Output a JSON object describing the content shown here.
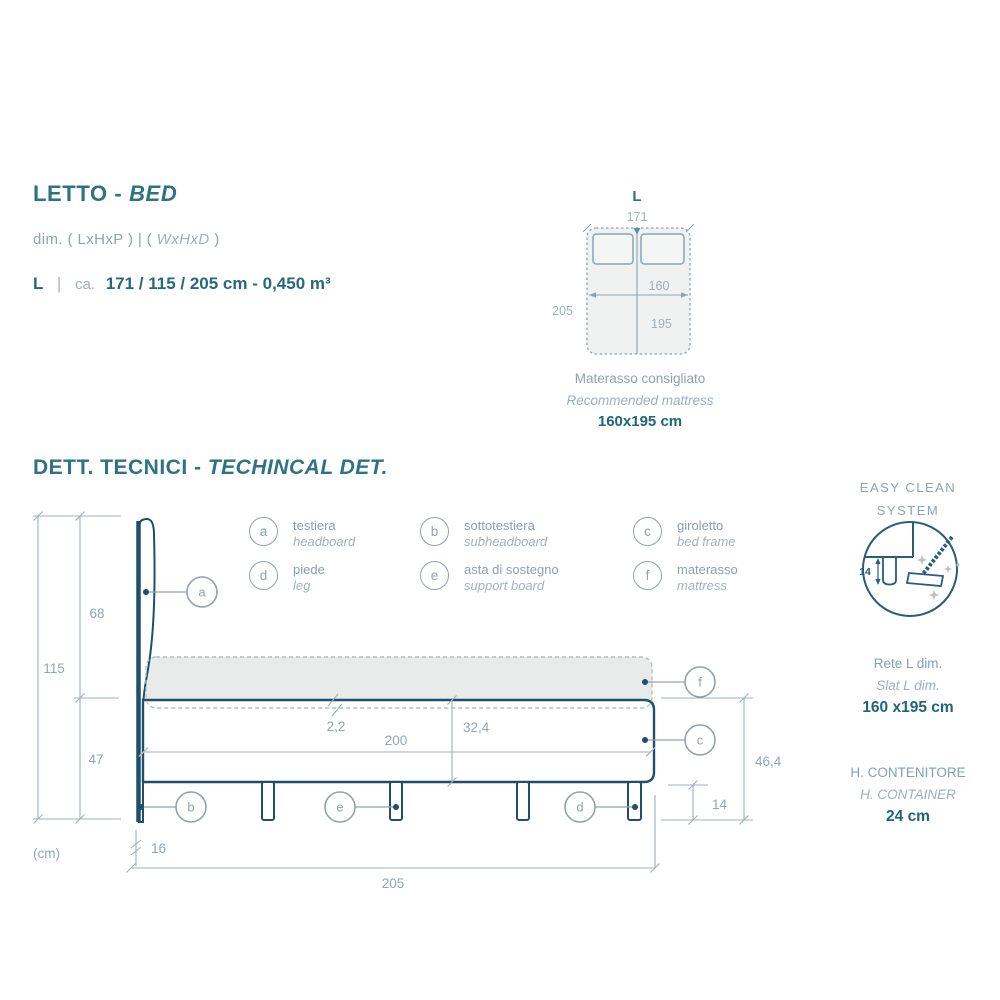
{
  "header": {
    "title_it": "LETTO -",
    "title_en": "BED",
    "dim_prefix": "dim. ( LxHxP )",
    "dim_pipe": "|",
    "dim_open": "(",
    "dim_italic": "WxHxD",
    "dim_close": ")",
    "size_code": "L",
    "size_pipe": "|",
    "size_approx": "ca.",
    "size_value": "171 / 115 / 205 cm - 0,450 m³"
  },
  "top_view": {
    "size_label": "L",
    "width": "171",
    "length": "205",
    "inner_width": "160",
    "inner_length": "195",
    "caption_it": "Materasso consigliato",
    "caption_en": "Recommended mattress",
    "caption_size": "160x195 cm"
  },
  "section": {
    "title_it": "DETT. TECNICI -",
    "title_en": "TECHINCAL DET."
  },
  "legend": {
    "items": [
      {
        "key": "a",
        "it": "testiera",
        "en": "headboard"
      },
      {
        "key": "b",
        "it": "sottotestiera",
        "en": "subheadboard"
      },
      {
        "key": "c",
        "it": "giroletto",
        "en": "bed frame"
      },
      {
        "key": "d",
        "it": "piede",
        "en": "leg"
      },
      {
        "key": "e",
        "it": "asta di sostegno",
        "en": "support board"
      },
      {
        "key": "f",
        "it": "materasso",
        "en": "mattress"
      }
    ]
  },
  "drawing": {
    "unit": "(cm)",
    "dims": {
      "total_height": "115",
      "headboard_above": "68",
      "lower_zone": "47",
      "headboard_thickness": "16",
      "length": "205",
      "inner_length": "200",
      "support_thickness": "2,2",
      "frame_height": "32,4",
      "side_height": "46,4",
      "leg_height": "14"
    }
  },
  "easy_clean": {
    "title_line1": "EASY CLEAN",
    "title_line2": "SYSTEM",
    "clearance": "14"
  },
  "slat": {
    "label_it": "Rete L dim.",
    "label_en": "Slat L dim.",
    "value": "160 x195 cm"
  },
  "container": {
    "label_it": "H. CONTENITORE",
    "label_en": "H. CONTAINER",
    "value": "24 cm"
  },
  "colors": {
    "navy": "#1f4f6a",
    "teal_heading": "#2e7285",
    "teal_value": "#1f6577",
    "dim_text": "#93a5b1",
    "light_line": "#b3bec4",
    "mattress_fill": "#e9ebeb",
    "topview_fill": "#f0f1f1"
  }
}
